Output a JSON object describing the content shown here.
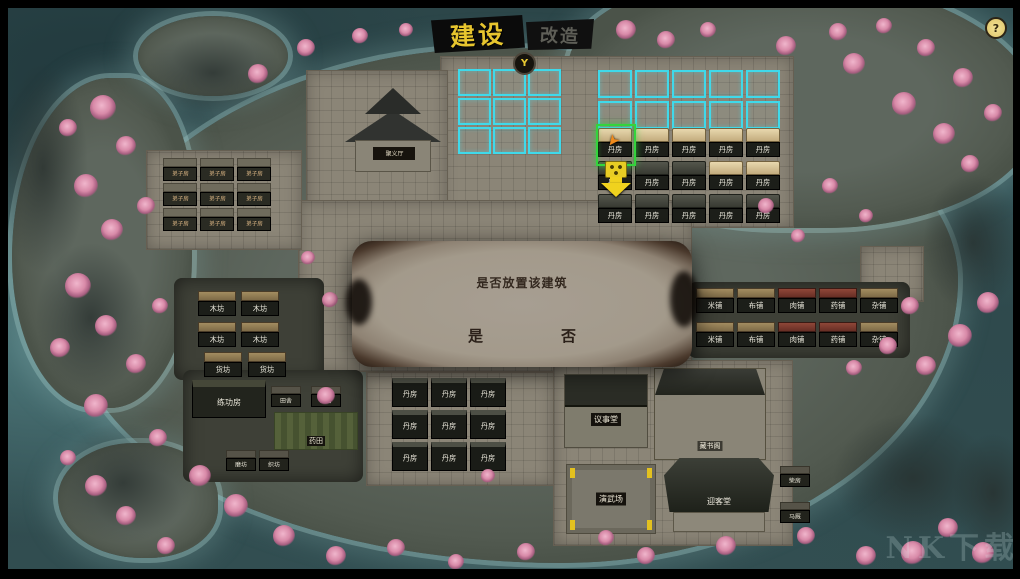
{
  "header": {
    "build_tab": "建设",
    "modify_tab": "改造",
    "controller_hint": "Y",
    "help": "?"
  },
  "dialog": {
    "message": "是否放置该建筑",
    "yes": "是",
    "no": "否"
  },
  "palette": {
    "row1": [
      {
        "label": "丹房",
        "cls": "roof-tan"
      },
      {
        "label": "丹房",
        "cls": "roof-tan"
      },
      {
        "label": "丹房",
        "cls": "roof-tan"
      },
      {
        "label": "丹房",
        "cls": "roof-tan"
      },
      {
        "label": "丹房",
        "cls": "roof-tan"
      }
    ],
    "row2": [
      {
        "label": "丹房",
        "cls": "roof-dark"
      },
      {
        "label": "丹房",
        "cls": "roof-dark"
      },
      {
        "label": "丹房",
        "cls": "roof-dark"
      },
      {
        "label": "丹房",
        "cls": "roof-tan"
      },
      {
        "label": "丹房",
        "cls": "roof-tan"
      }
    ],
    "row3": [
      {
        "label": "丹房",
        "cls": "roof-dark"
      },
      {
        "label": "丹房",
        "cls": "roof-dark"
      },
      {
        "label": "丹房",
        "cls": "roof-dark"
      },
      {
        "label": "丹房",
        "cls": "roof-dark"
      },
      {
        "label": "丹房",
        "cls": "roof-dark"
      }
    ]
  },
  "left_compound": [
    "弟子房",
    "弟子房",
    "弟子房",
    "弟子房",
    "弟子房",
    "弟子房",
    "弟子房",
    "弟子房",
    "弟子房"
  ],
  "quarters": [
    "丹房",
    "丹房",
    "丹房",
    "丹房",
    "丹房",
    "丹房",
    "丹房",
    "丹房",
    "丹房"
  ],
  "market_left": {
    "workshops": [
      "木坊",
      "木坊",
      "木坊",
      "木坊"
    ],
    "stores": [
      "货坊",
      "货坊"
    ]
  },
  "shops": {
    "row1": [
      {
        "label": "米铺"
      },
      {
        "label": "布铺"
      },
      {
        "label": "肉铺",
        "cls": "red"
      },
      {
        "label": "药铺",
        "cls": "red"
      },
      {
        "label": "杂铺"
      }
    ],
    "row2": [
      {
        "label": "米铺"
      },
      {
        "label": "布铺"
      },
      {
        "label": "肉铺",
        "cls": "red"
      },
      {
        "label": "药铺",
        "cls": "red"
      },
      {
        "label": "杂铺"
      }
    ]
  },
  "farm_huts": [
    "田舍",
    "田舍"
  ],
  "mills": [
    "磨坊",
    "织坊"
  ],
  "halls": {
    "pagoda": "聚义厅",
    "council": "议事堂",
    "library": "藏书阁",
    "arena": "演武场",
    "great_hall": "迎客堂",
    "training": "练功房",
    "field": "药田",
    "firewood": "柴房",
    "stable": "马厩"
  },
  "colors": {
    "plot_outline": "#3fd9ea",
    "selection": "#33d43c",
    "placement_marker": "#f0d21e",
    "tab_active_text": "#e7c52e"
  },
  "watermark": "NK下载"
}
